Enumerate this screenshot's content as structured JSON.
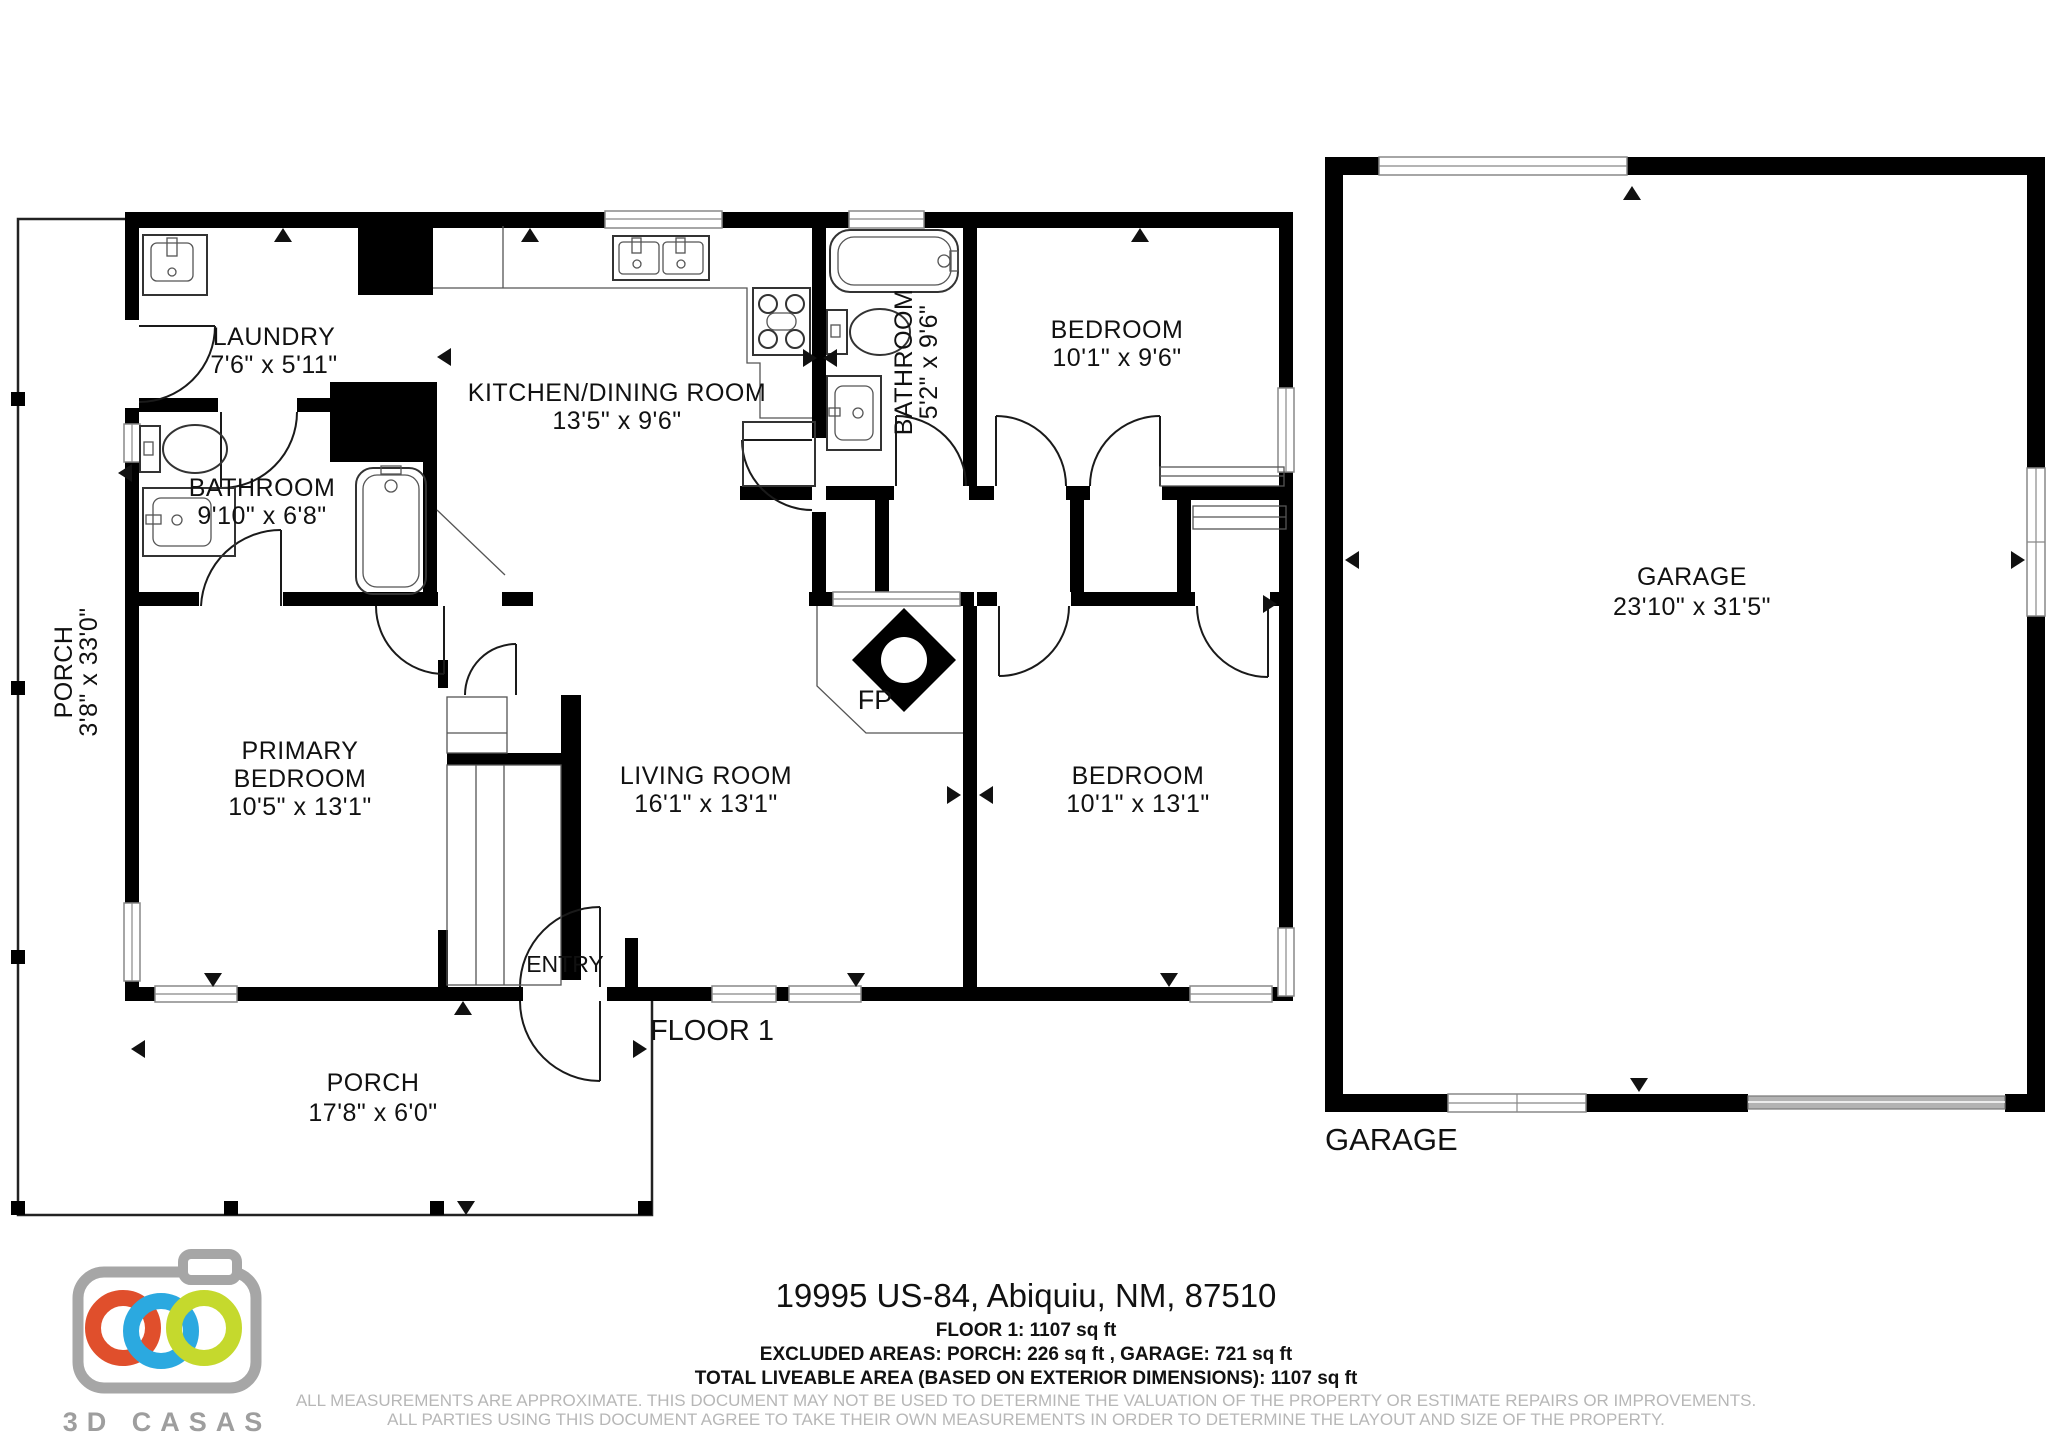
{
  "document": {
    "floor_label": "FLOOR 1",
    "entry_label": "ENTRY",
    "fireplace_label": "FP",
    "garage_outside_label": "GARAGE"
  },
  "rooms": {
    "laundry": {
      "name": "LAUNDRY",
      "dims": "7'6\" x 5'11\""
    },
    "kitchen": {
      "name": "KITCHEN/DINING ROOM",
      "dims": "13'5\" x 9'6\""
    },
    "hall_bathroom": {
      "name": "BATHROOM",
      "dims": "5'2\" x 9'6\""
    },
    "bedroom_top": {
      "name": "BEDROOM",
      "dims": "10'1\" x 9'6\""
    },
    "main_bathroom": {
      "name": "BATHROOM",
      "dims": "9'10\" x 6'8\""
    },
    "side_porch": {
      "name": "PORCH",
      "dims": "3'8\" x 33'0\""
    },
    "primary_bedroom": {
      "line1": "PRIMARY",
      "line2": "BEDROOM",
      "dims": "10'5\" x 13'1\""
    },
    "living_room": {
      "name": "LIVING ROOM",
      "dims": "16'1\" x 13'1\""
    },
    "bedroom_bottom": {
      "name": "BEDROOM",
      "dims": "10'1\" x 13'1\""
    },
    "front_porch": {
      "name": "PORCH",
      "dims": "17'8\" x 6'0\""
    },
    "garage": {
      "name": "GARAGE",
      "dims": "23'10\" x 31'5\""
    }
  },
  "footer": {
    "address": "19995 US-84, Abiquiu, NM, 87510",
    "floor_area": "FLOOR 1: 1107 sq ft",
    "excluded": "EXCLUDED AREAS: PORCH: 226 sq ft , GARAGE: 721 sq ft",
    "total": "TOTAL LIVEABLE AREA (BASED ON EXTERIOR DIMENSIONS): 1107 sq ft",
    "disclaimer1": "ALL MEASUREMENTS ARE APPROXIMATE. THIS DOCUMENT MAY NOT BE USED TO DETERMINE THE VALUATION OF THE PROPERTY OR ESTIMATE REPAIRS OR IMPROVEMENTS.",
    "disclaimer2": "ALL PARTIES USING THIS DOCUMENT AGREE TO TAKE THEIR OWN MEASUREMENTS IN ORDER TO DETERMINE THE LAYOUT AND SIZE OF THE PROPERTY."
  },
  "logo": {
    "text": "3D CASAS",
    "colors": {
      "red": "#e04f2c",
      "blue": "#2ba9e0",
      "green": "#c5d92d",
      "gray": "#a6a6a6"
    }
  }
}
